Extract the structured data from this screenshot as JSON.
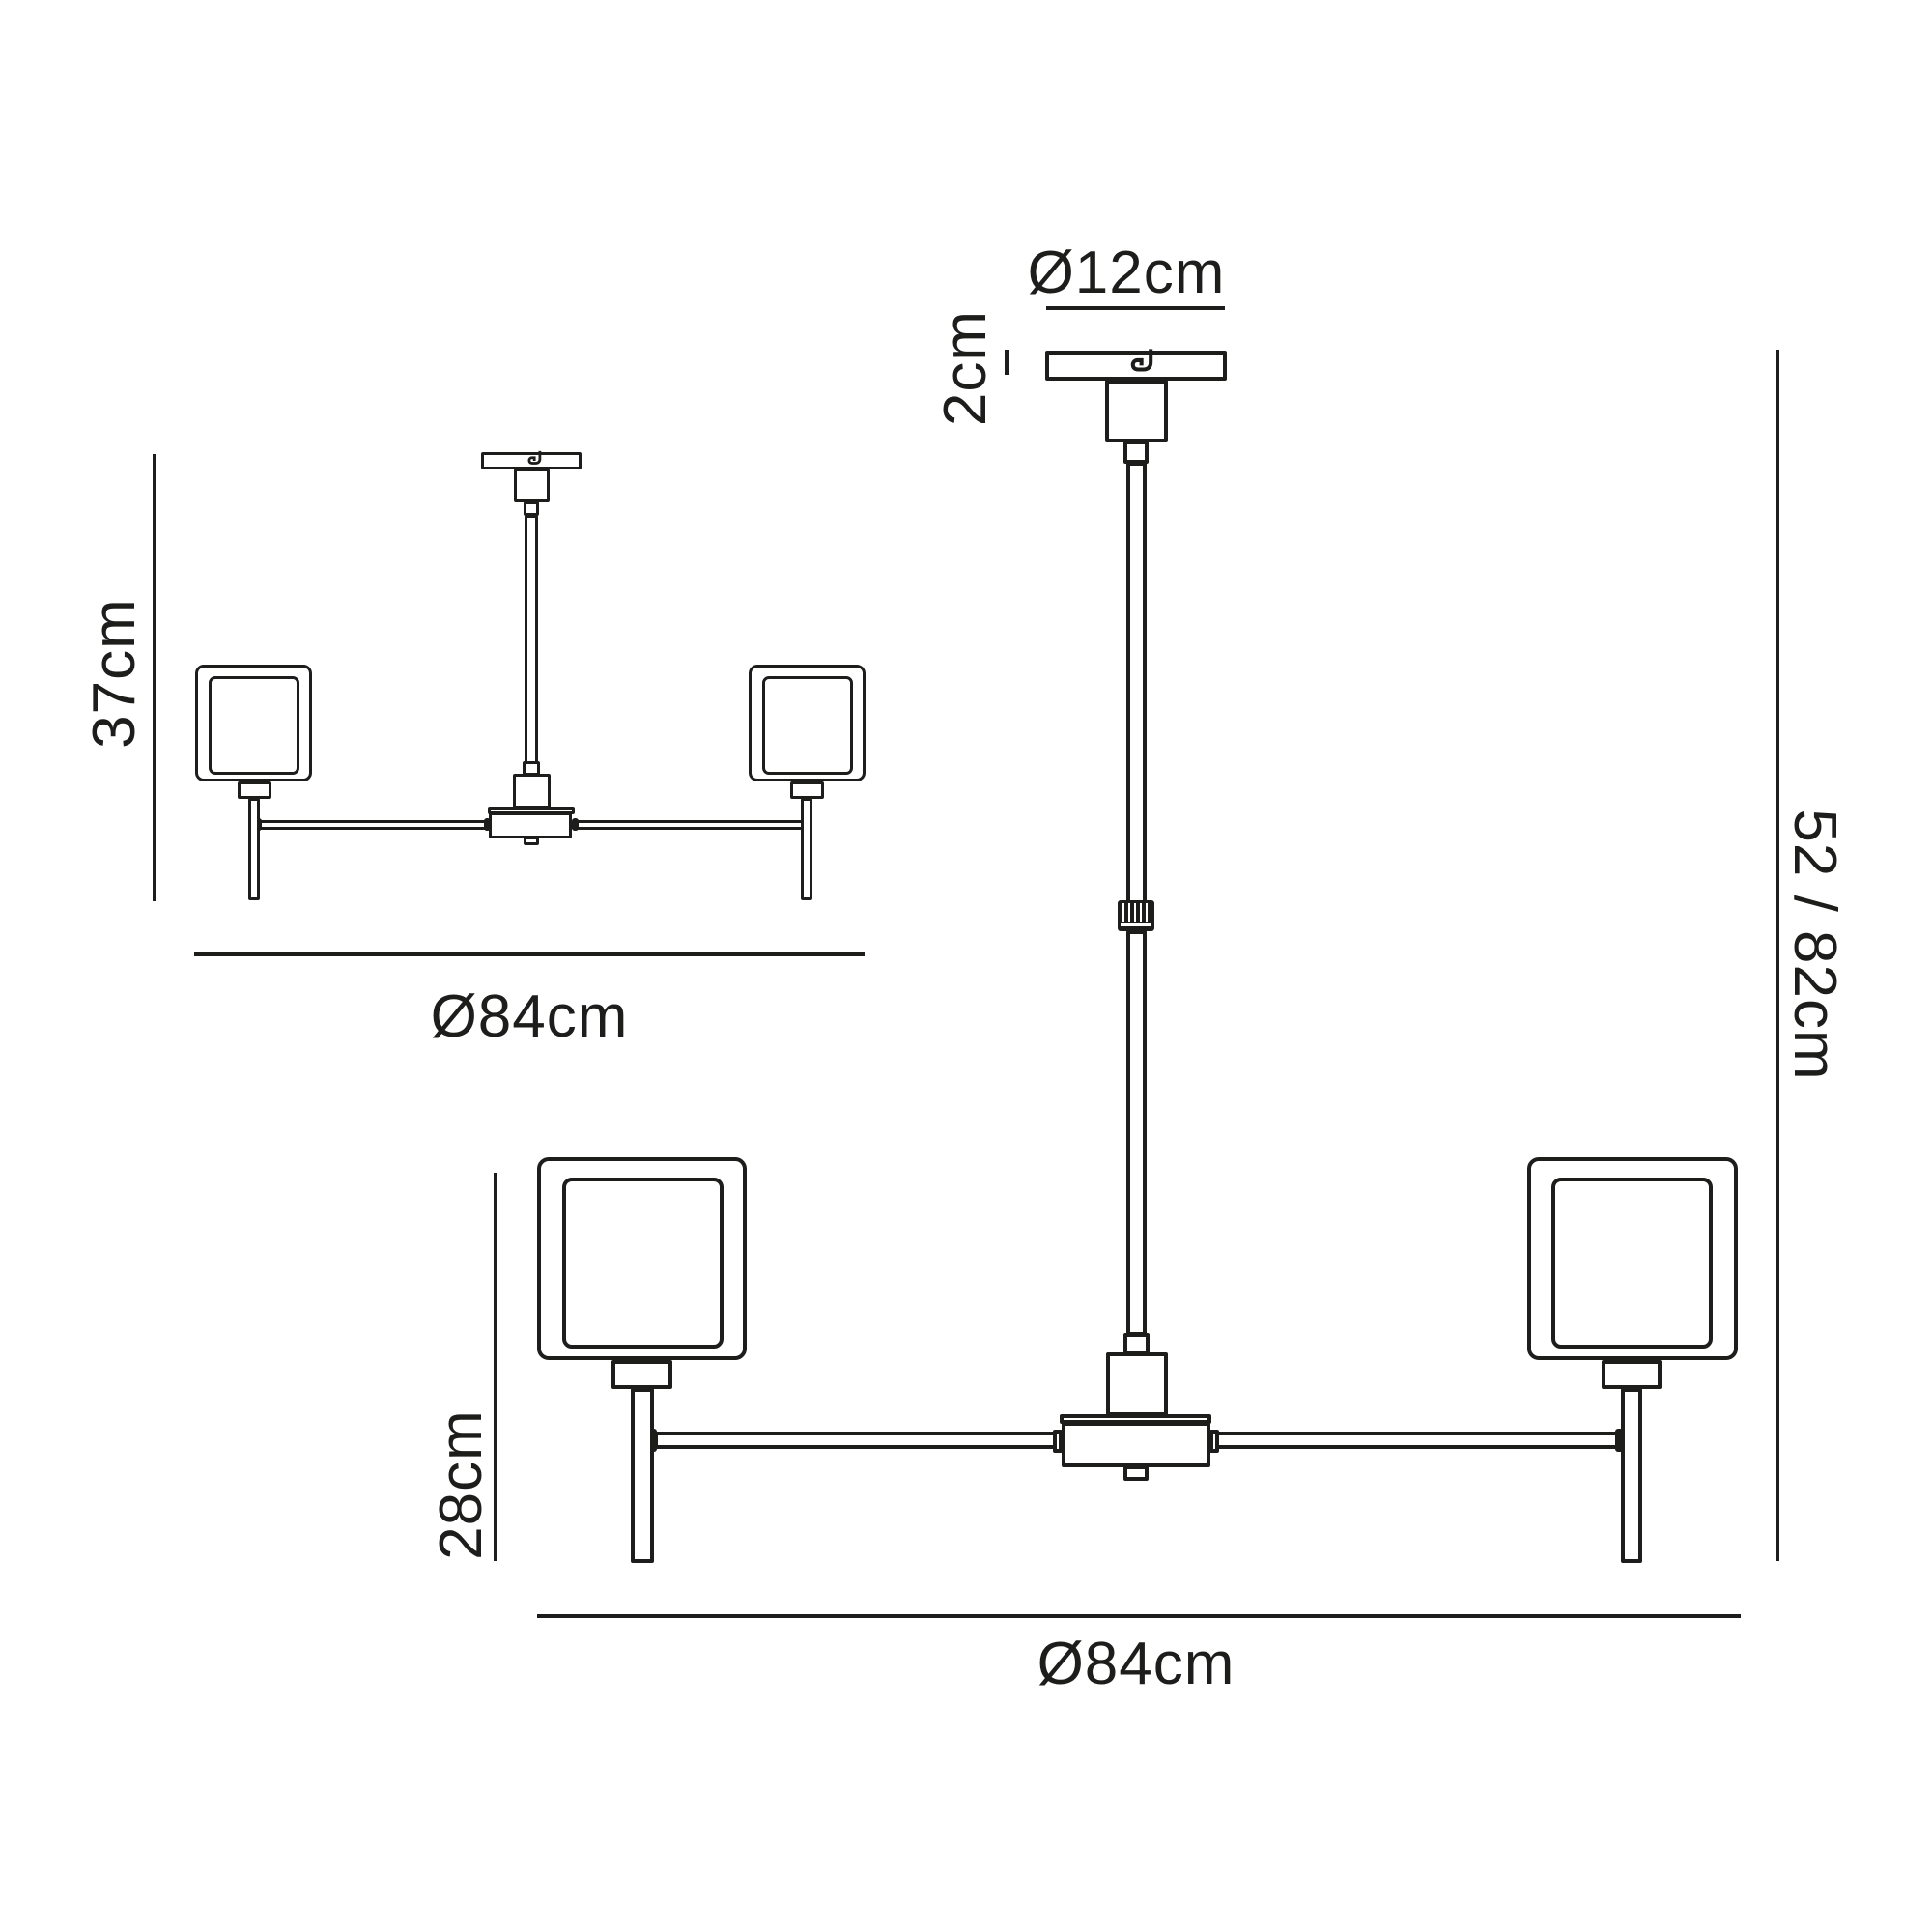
{
  "page": {
    "background": "#ffffff",
    "line_color": "#1d1d1b"
  },
  "side_view": {
    "height_label": "37cm",
    "diameter_label": "Ø84cm"
  },
  "front_view": {
    "canopy_diameter_label": "Ø12cm",
    "canopy_height_label": "2cm",
    "shade_height_label": "28cm",
    "drop_height_label": "52 / 82cm",
    "diameter_label": "Ø84cm"
  }
}
